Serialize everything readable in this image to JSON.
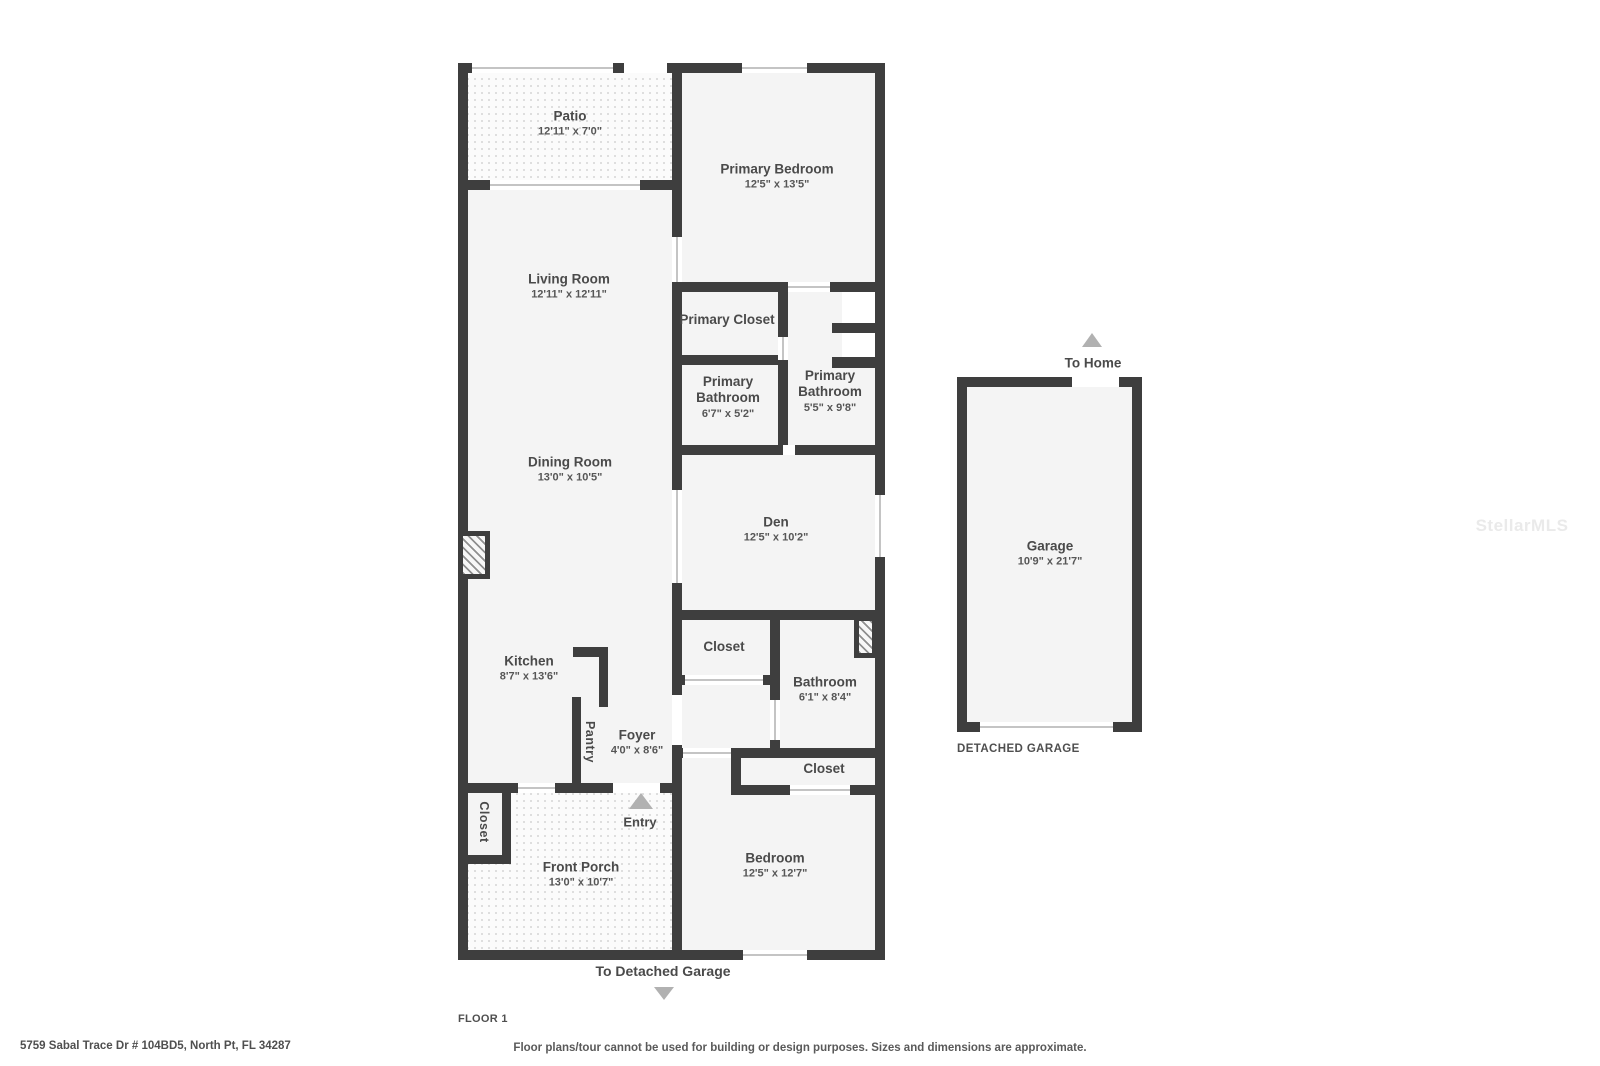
{
  "page": {
    "address": "5759 Sabal Trace Dr # 104BD5, North Pt, FL 34287",
    "floor_label": "FLOOR 1",
    "disclaimer": "Floor plans/tour cannot be used for building or design purposes. Sizes and dimensions are approximate.",
    "watermark": "StellarMLS"
  },
  "annotations": {
    "entry": "Entry",
    "to_home": "To Home",
    "to_detached_garage": "To Detached Garage",
    "detached_garage": "DETACHED GARAGE"
  },
  "rooms": {
    "patio": {
      "name": "Patio",
      "dims": "12'11\" x 7'0\""
    },
    "primary_bedroom": {
      "name": "Primary Bedroom",
      "dims": "12'5\" x 13'5\""
    },
    "living_room": {
      "name": "Living Room",
      "dims": "12'11\" x 12'11\""
    },
    "dining_room": {
      "name": "Dining Room",
      "dims": "13'0\" x 10'5\""
    },
    "primary_closet": {
      "name": "Primary Closet"
    },
    "primary_bathroom_a": {
      "name": "Primary Bathroom",
      "dims": "6'7\" x 5'2\""
    },
    "primary_bathroom_b": {
      "name": "Primary Bathroom",
      "dims": "5'5\" x 9'8\""
    },
    "den": {
      "name": "Den",
      "dims": "12'5\" x 10'2\""
    },
    "hall_closet": {
      "name": "Closet"
    },
    "bathroom": {
      "name": "Bathroom",
      "dims": "6'1\" x 8'4\""
    },
    "bedroom_closet": {
      "name": "Closet"
    },
    "kitchen": {
      "name": "Kitchen",
      "dims": "8'7\" x 13'6\""
    },
    "pantry": {
      "name": "Pantry"
    },
    "foyer": {
      "name": "Foyer",
      "dims": "4'0\" x 8'6\""
    },
    "porch_closet": {
      "name": "Closet"
    },
    "front_porch": {
      "name": "Front Porch",
      "dims": "13'0\" x 10'7\""
    },
    "bedroom": {
      "name": "Bedroom",
      "dims": "12'5\" x 12'7\""
    },
    "garage": {
      "name": "Garage",
      "dims": "10'9\" x 21'7\""
    }
  }
}
